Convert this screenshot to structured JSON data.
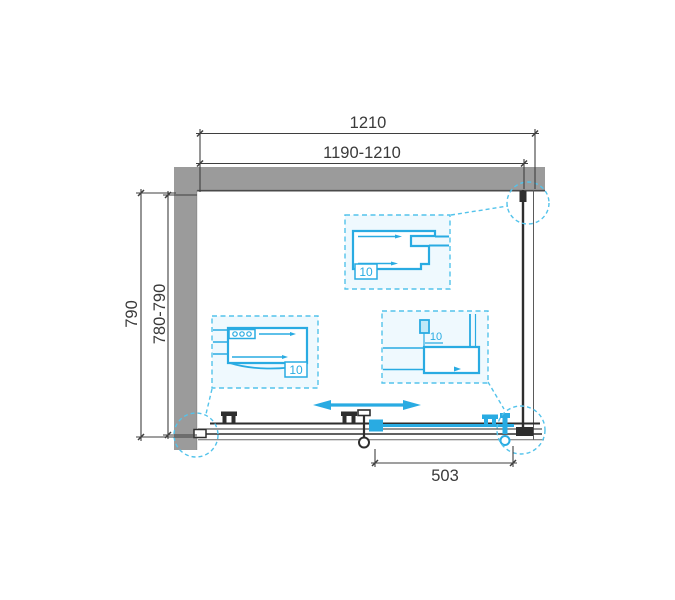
{
  "dimensions": {
    "top_outer": "1210",
    "top_adjustable": "1190-1210",
    "side_outer": "790",
    "side_adjustable": "780-790",
    "door_opening": "503"
  },
  "details": {
    "wall_profile_right": {
      "label": "10"
    },
    "wall_profile_left": {
      "label": "10"
    },
    "bottom_rail": {
      "label": "10"
    }
  },
  "colors": {
    "accent": "#29ABE2",
    "accent_dashed": "#53C3EB",
    "wall_gray": "#9B9B9B",
    "line_dark": "#3A3A3A",
    "detail_fill": "#EFF9FE"
  }
}
